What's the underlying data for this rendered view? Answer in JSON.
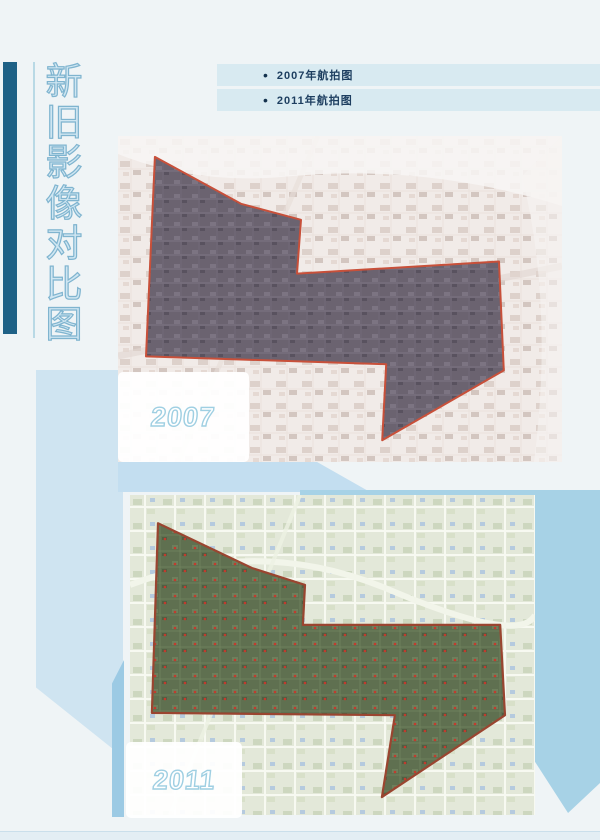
{
  "poster": {
    "title_vertical": "新旧影像对比图",
    "title_chars": [
      "新",
      "旧",
      "影",
      "像",
      "对",
      "比",
      "图"
    ]
  },
  "legend": {
    "bullet": "•",
    "items": [
      {
        "label": "2007年航拍图"
      },
      {
        "label": "2011年航拍图"
      }
    ]
  },
  "maps": [
    {
      "year_label": "2007",
      "region_outline_color": "#c8503a",
      "region_fill_color": "#6b6370"
    },
    {
      "year_label": "2011",
      "region_outline_color": "#9a4530",
      "region_fill_color": "#5f7050"
    }
  ],
  "colors": {
    "page_background": "#eff4f6",
    "sidebar_bar": "#1e6186",
    "vertical_title_text": "#7fb4cf",
    "legend_band": "#d8eaf1",
    "legend_text": "#1d3e60",
    "year_label_outline": "#9fcfe2",
    "panel_pale_blue": "#cfe4f1",
    "panel_right_blue": "#a7d2e6",
    "strip_mid_blue": "#9ccae4"
  }
}
